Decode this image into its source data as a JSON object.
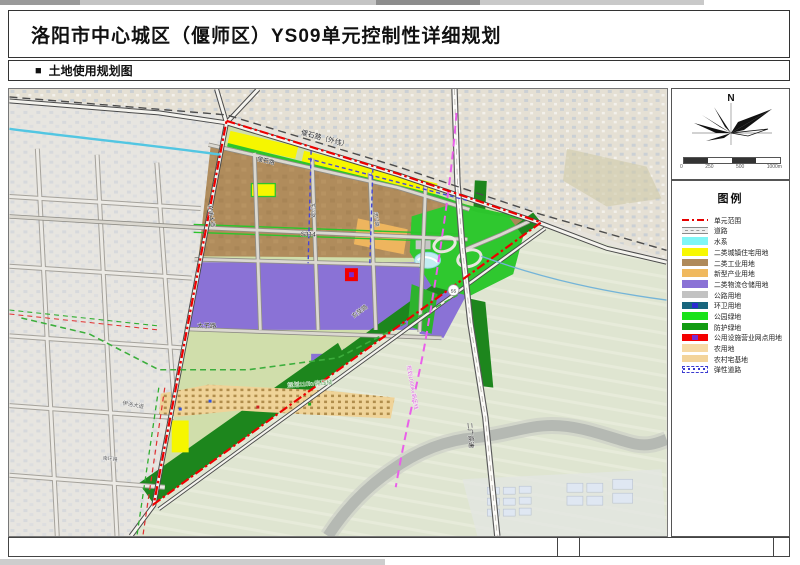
{
  "header": {
    "title": "洛阳市中心城区（偃师区）YS09单元控制性详细规划",
    "section_marker": "■",
    "section_title": "土地使用规划图"
  },
  "compass": {
    "north_label": "N"
  },
  "scalebar": {
    "labels": [
      "0",
      "250",
      "500",
      "1000m"
    ]
  },
  "legend": {
    "title": "图例",
    "items": [
      {
        "label": "单元范围",
        "type": "boundary-line",
        "color": "#e60000"
      },
      {
        "label": "道路",
        "type": "road-symbol",
        "color": "#bdbdbd"
      },
      {
        "label": "水系",
        "type": "fill",
        "color": "#7ff6f6"
      },
      {
        "label": "二类城镇住宅用地",
        "type": "fill",
        "color": "#f8f800"
      },
      {
        "label": "二类工业用地",
        "type": "fill",
        "color": "#b08a5a"
      },
      {
        "label": "新型产业用地",
        "type": "fill",
        "color": "#f0b95e"
      },
      {
        "label": "二类物流仓储用地",
        "type": "fill",
        "color": "#8a72d6"
      },
      {
        "label": "公路用地",
        "type": "fill",
        "color": "#c2c2c2"
      },
      {
        "label": "环卫用地",
        "type": "fill-dot",
        "color": "#17657d",
        "dot": "#2b2bd0"
      },
      {
        "label": "公园绿地",
        "type": "fill",
        "color": "#19e219"
      },
      {
        "label": "防护绿地",
        "type": "fill",
        "color": "#129b12"
      },
      {
        "label": "公用设施营业网点用地",
        "type": "fill-dot",
        "color": "#f40000",
        "dot": "#7b2bd0"
      },
      {
        "label": "农用地",
        "type": "fill",
        "color": "#f6d9a4"
      },
      {
        "label": "农村宅基地",
        "type": "fill",
        "color": "#f3d49b"
      },
      {
        "label": "弹性道路",
        "type": "elastic-road",
        "color": "#3b3bd0"
      }
    ]
  },
  "map": {
    "labels": [
      {
        "text": "偃石路（外线）"
      },
      {
        "text": "偃石路"
      },
      {
        "text": "S314"
      },
      {
        "text": "东兴路"
      },
      {
        "text": "忠兴路"
      },
      {
        "text": "杜甫大道"
      },
      {
        "text": "太子路"
      },
      {
        "text": "玄奘路"
      },
      {
        "text": "二广高速"
      },
      {
        "text": "伊洛大道"
      },
      {
        "text": "南环路"
      },
      {
        "text": "规划110kv高压线"
      },
      {
        "text": "规划1000kv高压线"
      },
      {
        "text": "55"
      }
    ],
    "boundary_color": "#ee0000",
    "highvoltage_110kv_color": "#3cae3c",
    "highvoltage_1000kv_color": "#ea5fea"
  }
}
